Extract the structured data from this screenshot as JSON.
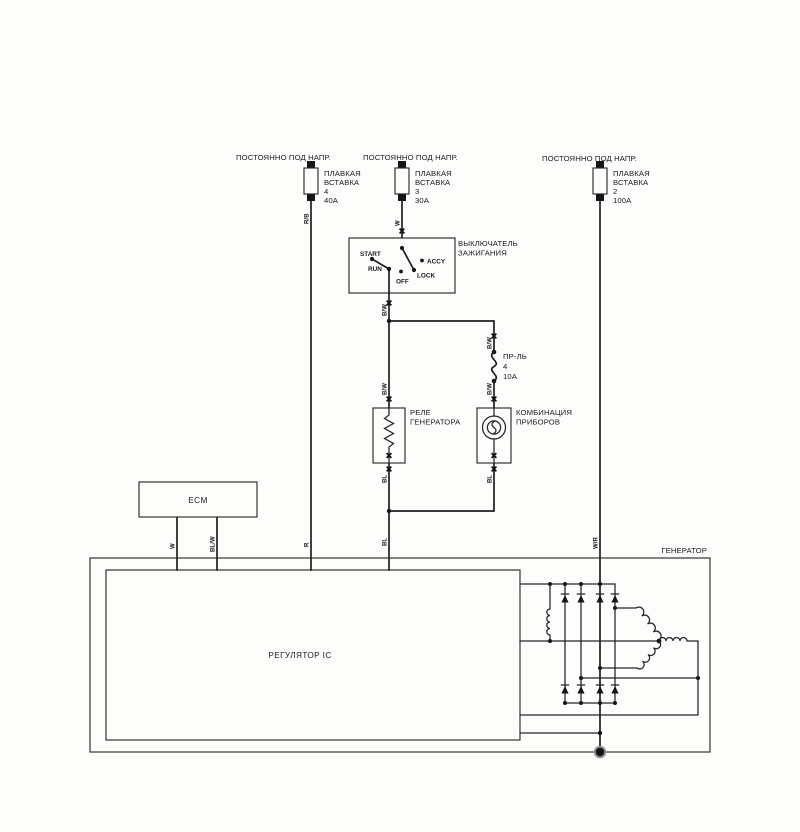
{
  "power_labels": [
    "ПОСТОЯННО ПОД НАПР.",
    "ПОСТОЯННО ПОД НАПР.",
    "ПОСТОЯННО ПОД НАПР."
  ],
  "fuses": [
    {
      "name_line1": "ПЛАВКАЯ",
      "name_line2": "ВСТАВКА",
      "number": "4",
      "rating": "40А"
    },
    {
      "name_line1": "ПЛАВКАЯ",
      "name_line2": "ВСТАВКА",
      "number": "3",
      "rating": "30А"
    },
    {
      "name_line1": "ПЛАВКАЯ",
      "name_line2": "ВСТАВКА",
      "number": "2",
      "rating": "100А"
    }
  ],
  "ignition_switch": {
    "label_line1": "ВЫКЛЮЧАТЕЛЬ",
    "label_line2": "ЗАЖИГАНИЯ",
    "pos_start": "START",
    "pos_run": "RUN",
    "pos_off": "OFF",
    "pos_accy": "ACCY",
    "pos_lock": "LOCK"
  },
  "inline_fuse": {
    "name": "ПР-ЛЬ",
    "number": "4",
    "rating": "10А"
  },
  "relay": {
    "label_line1": "РЕЛЕ",
    "label_line2": "ГЕНЕРАТОРА"
  },
  "cluster": {
    "label_line1": "КОМБИНАЦИЯ",
    "label_line2": "ПРИБОРОВ"
  },
  "ecm": {
    "label": "ECM"
  },
  "generator": {
    "label": "ГЕНЕРАТОР",
    "regulator_label": "РЕГУЛЯТОР IC"
  },
  "wire_labels": {
    "rb": "R/B",
    "w": "W",
    "bw": "B/W",
    "bl": "BL",
    "r": "R",
    "blw": "BL/W",
    "wr": "W/R"
  }
}
